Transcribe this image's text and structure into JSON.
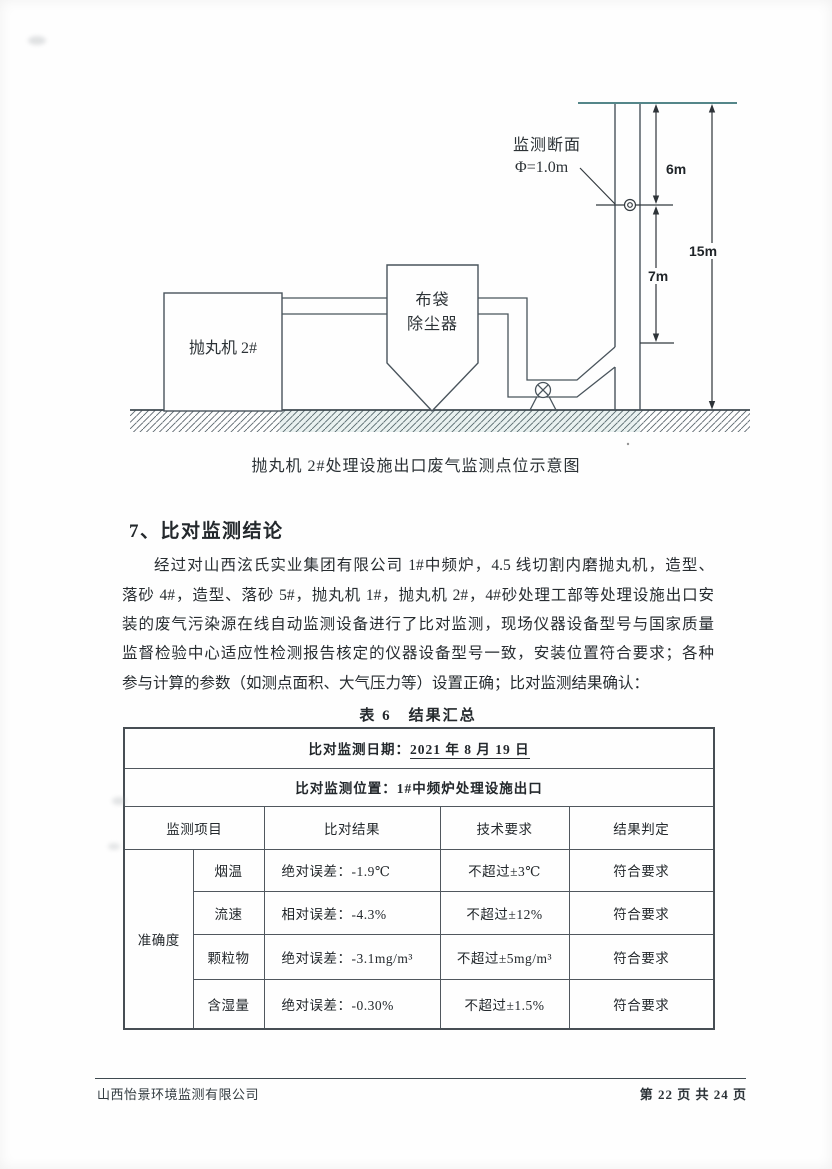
{
  "diagram": {
    "machine_label": "抛丸机 2#",
    "collector_label_line1": "布袋",
    "collector_label_line2": "除尘器",
    "section_label_line1": "监测断面",
    "section_label_line2": "Φ=1.0m",
    "dim_top": "6m",
    "dim_mid": "7m",
    "dim_total": "15m",
    "caption": "抛丸机 2#处理设施出口废气监测点位示意图",
    "colors": {
      "line": "#49545c",
      "stack_top_line": "#3c7478",
      "ground_tint": "#2e7d74"
    }
  },
  "section": {
    "heading": "7、比对监测结论",
    "paragraph_lines": [
      "经过对山西泫氏实业集团有限公司 1#中频炉，4.5 线切割内磨抛丸机，造型、",
      "落砂 4#，造型、落砂 5#，抛丸机 1#，抛丸机 2#，4#砂处理工部等处理设施出口安",
      "装的废气污染源在线自动监测设备进行了比对监测，现场仪器设备型号与国家质量",
      "监督检验中心适应性检测报告核定的仪器设备型号一致，安装位置符合要求；各种",
      "参与计算的参数（如测点面积、大气压力等）设置正确；比对监测结果确认："
    ]
  },
  "table": {
    "title": "表 6　结果汇总",
    "date_label": "比对监测日期：",
    "date_value": "2021 年 8 月 19 日",
    "location": "比对监测位置：1#中频炉处理设施出口",
    "headers": [
      "监测项目",
      "比对结果",
      "技术要求",
      "结果判定"
    ],
    "group_label": "准确度",
    "rows": [
      {
        "item": "烟温",
        "result": "绝对误差：-1.9℃",
        "requirement": "不超过±3℃",
        "judgement": "符合要求"
      },
      {
        "item": "流速",
        "result": "相对误差：-4.3%",
        "requirement": "不超过±12%",
        "judgement": "符合要求"
      },
      {
        "item": "颗粒物",
        "result": "绝对误差：-3.1mg/m³",
        "requirement": "不超过±5mg/m³",
        "judgement": "符合要求"
      },
      {
        "item": "含湿量",
        "result": "绝对误差：-0.30%",
        "requirement": "不超过±1.5%",
        "judgement": "符合要求"
      }
    ]
  },
  "footer": {
    "company": "山西怡景环境监测有限公司",
    "page_info": "第 22 页 共 24 页"
  }
}
